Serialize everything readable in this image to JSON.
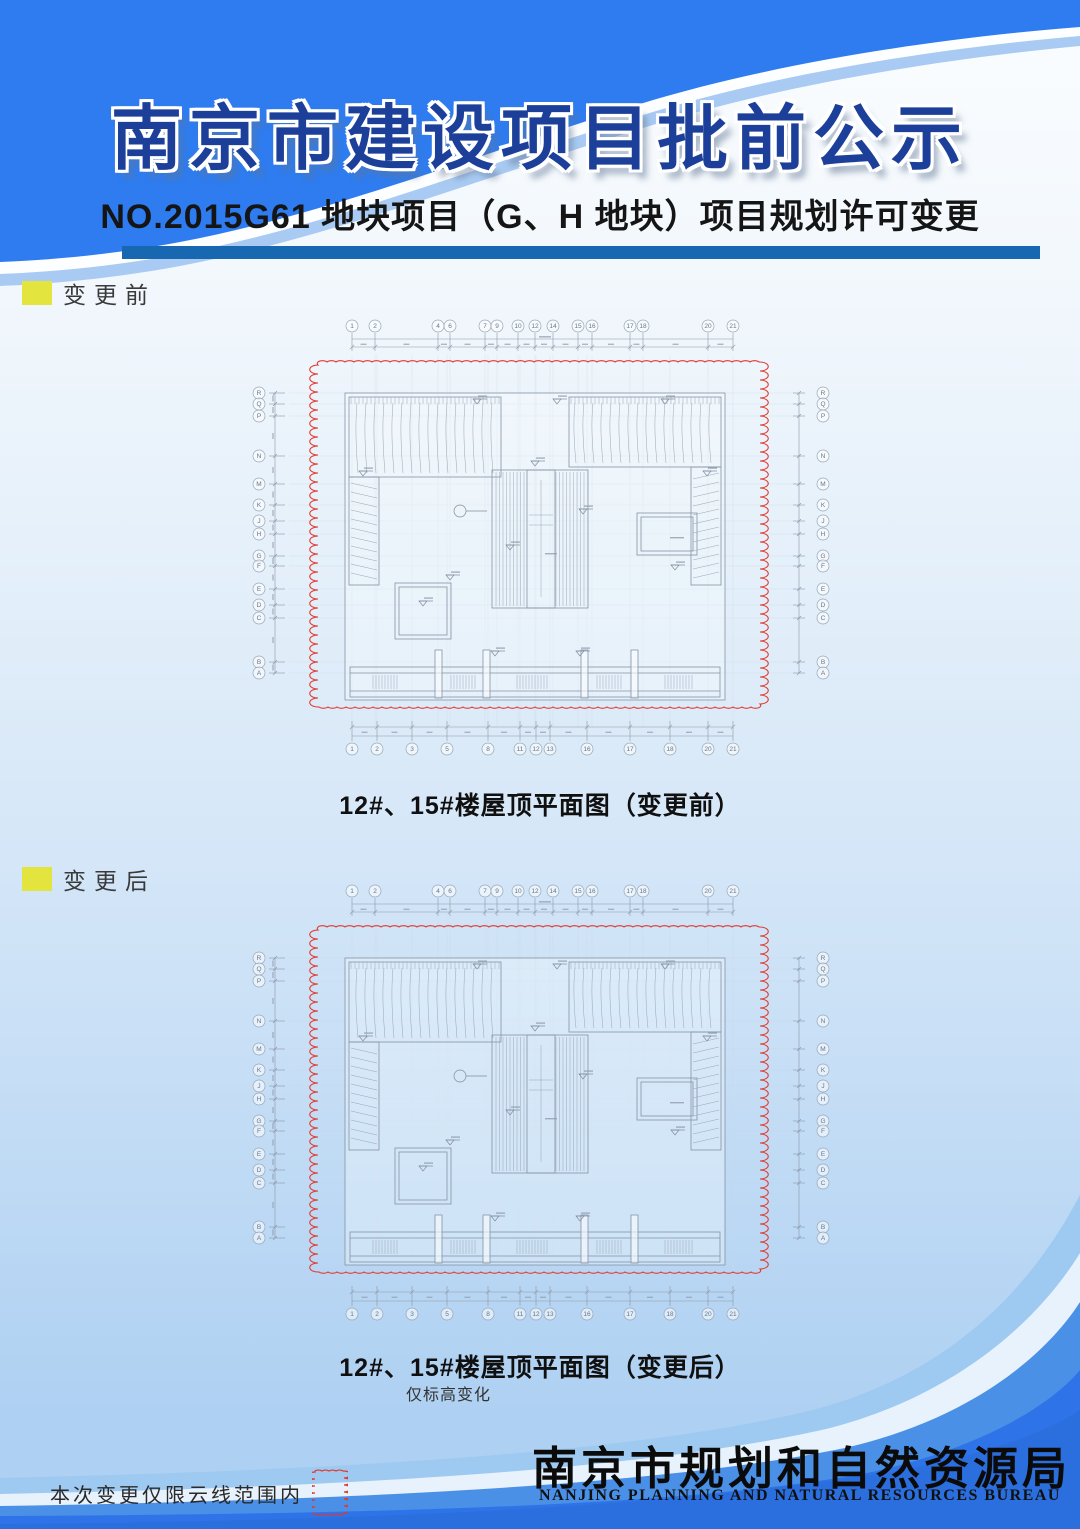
{
  "header": {
    "title": "南京市建设项目批前公示",
    "subtitle": "NO.2015G61 地块项目（G、H 地块）项目规划许可变更"
  },
  "sections": {
    "before": {
      "label": "变更前",
      "caption": "12#、15#楼屋顶平面图（变更前）"
    },
    "after": {
      "label": "变更后",
      "caption": "12#、15#楼屋顶平面图（变更后）",
      "caption_note": "仅标高变化"
    }
  },
  "plan": {
    "drawing_type": "roof-plan",
    "grid_top_numbers": [
      "1",
      "2",
      "4",
      "6",
      "7",
      "9",
      "10",
      "12",
      "14",
      "15",
      "16",
      "17",
      "18",
      "20",
      "21"
    ],
    "grid_bottom_numbers": [
      "1",
      "2",
      "3",
      "5",
      "8",
      "11",
      "12",
      "13",
      "16",
      "17",
      "18",
      "20",
      "21"
    ],
    "grid_row_letters": [
      "R",
      "Q",
      "P",
      "N",
      "M",
      "K",
      "J",
      "H",
      "G",
      "F",
      "E",
      "D",
      "C",
      "B",
      "A"
    ]
  },
  "footer": {
    "agency_cn": "南京市规划和自然资源局",
    "agency_en": "NANJING  PLANNING  AND  NATURAL  RESOURCES  BUREAU",
    "note": "本次变更仅限云线范围内",
    "note_symbol": "revision-cloud-icon"
  },
  "colors": {
    "header_blue": "#2e7cf0",
    "header_light_blue": "#a9cbf3",
    "title_navy": "#1c3f9a",
    "subtitle_bar_blue": "#1767b1",
    "marker_yellow": "#e4e43e",
    "revision_cloud_red": "#e2382c",
    "footer_band_blue": "#2e74e8",
    "footer_band_mid_blue": "#4a90e6",
    "drawing_line_gray": "#8593a6"
  }
}
